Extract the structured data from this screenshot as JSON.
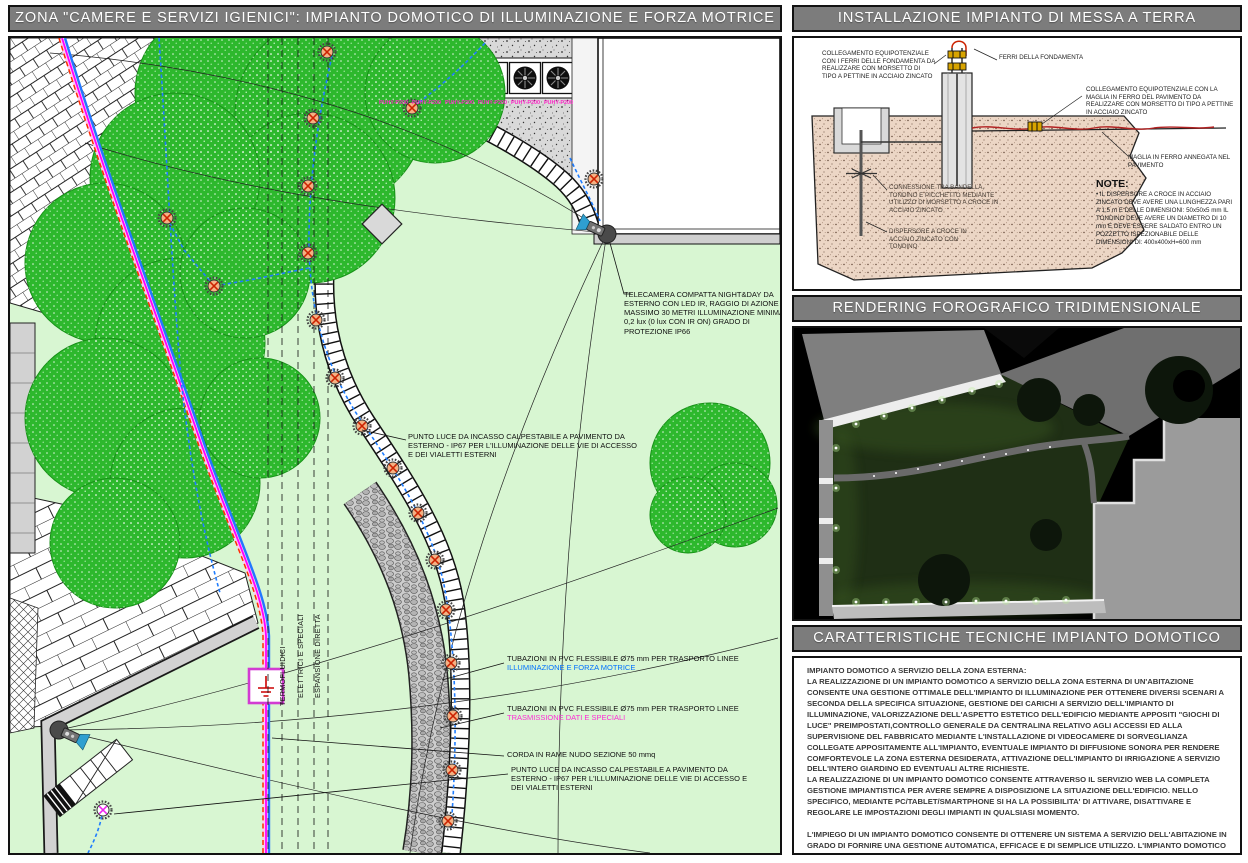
{
  "left": {
    "title": "ZONA \"CAMERE E SERVIZI IGIENICI\": IMPIANTO DOMOTICO DI ILLUMINAZIONE E FORZA MOTRICE",
    "corridor_labels": [
      "TERMOFLUIDICI",
      "ELETTRICI E SPECIALI",
      "ESPANSIONE DIRETTA"
    ],
    "unit_labels": [
      "PUHY-P200",
      "PUHY-P200",
      "PUHY-P200",
      "PUHY-P200",
      "PUHY-P200",
      "PUHY-P200"
    ],
    "annotations": {
      "camera": "TELECAMERA COMPATTA NIGHT&DAY DA ESTERNO CON LED IR, RAGGIO DI AZIONE MASSIMO 30 METRI ILLUMINAZIONE MINIMA 0,2 lux (0 lux CON IR ON) GRADO DI PROTEZIONE IP66",
      "floor_light_top": "PUNTO LUCE DA INCASSO CALPESTABILE A PAVIMENTO DA ESTERNO - IP67 PER L'ILLUMINAZIONE DELLE VIE DI ACCESSO E DEI VIALETTI ESTERNI",
      "pvc_power_prefix": "TUBAZIONI IN PVC FLESSIBILE Ø75 mm PER TRASPORTO LINEE ",
      "pvc_power_highlight": "ILLUMINAZIONE E FORZA MOTRICE",
      "pvc_data_prefix": "TUBAZIONI IN PVC FLESSIBILE Ø75 mm PER TRASPORTO LINEE ",
      "pvc_data_highlight": "TRASMISSIONE DATI E SPECIALI",
      "copper_rope": "CORDA IN RAME NUDO SEZIONE 50 mmq",
      "floor_light_bottom": "PUNTO LUCE DA INCASSO CALPESTABILE A PAVIMENTO DA ESTERNO - IP67 PER L'ILLUMINAZIONE DELLE VIE DI ACCESSO E DEI VIALETTI ESTERNI"
    }
  },
  "grounding": {
    "title": "INSTALLAZIONE IMPIANTO DI MESSA A TERRA",
    "labels": {
      "equipotential_foundation": "COLLEGAMENTO EQUIPOTENZIALE CON I FERRI DELLE FONDAMENTA DA REALIZZARE CON MORSETTO DI TIPO A PETTINE IN ACCIAIO ZINCATO",
      "foundation_bars": "FERRI DELLA FONDAMENTA",
      "equipotential_floor": "COLLEGAMENTO EQUIPOTENZIALE CON LA MAGLIA IN FERRO DEL PAVIMENTO DA REALIZZARE CON MORSETTO DI TIPO A PETTINE IN ACCIAIO ZINCATO",
      "floor_mesh": "MAGLIA IN FERRO ANNEGATA NEL PAVIMENTO",
      "connection": "CONNESSIONE TRA BANDELLA, TONDINO E PICCHETTO MEDIANTE UTILIZZO DI MORSETTO A CROCE IN ACCIAIO ZINCATO",
      "earth_rod": "DISPERSORE A CROCE IN ACCIAIO ZINCATO CON TONDINO",
      "note_title": "NOTE:",
      "note_body": "• IL DISPERSORE A CROCE IN ACCIAIO ZINCATO DEVE AVERE UNA LUNGHEZZA PARI A 1,5 m E DELLE DIMENSIONI: 50x50x5 mm IL TONDINO DEVE AVERE UN DIAMETRO DI 10 mm E DEVE ESSERE SALDATO ENTRO UN POZZETTO ISPEZIONABILE DELLE DIMENSIONI DI: 400x400xH=600 mm"
    }
  },
  "rendering": {
    "title": "RENDERING FOROGRAFICO TRIDIMENSIONALE"
  },
  "tech": {
    "title": "CARATTERISTICHE TECNICHE IMPIANTO DOMOTICO",
    "p1_heading": "IMPIANTO DOMOTICO A SERVIZIO DELLA ZONA ESTERNA:",
    "p1": "LA REALIZZAZIONE DI UN IMPIANTO DOMOTICO A SERVIZIO DELLA ZONA ESTERNA DI UN'ABITAZIONE CONSENTE UNA GESTIONE OTTIMALE DELL'IMPIANTO DI ILLUMINAZIONE PER OTTENERE DIVERSI SCENARI A SECONDA DELLA SPECIFICA SITUAZIONE, GESTIONE DEI CARICHI A SERVIZIO DELL'IMPIANTO DI ILLUMINAZIONE, VALORIZZAZIONE DELL'ASPETTO ESTETICO DELL'EDIFICIO MEDIANTE APPOSITI \"GIOCHI DI LUCE\" PREIMPOSTATI,CONTROLLO GENERALE DA CENTRALINA RELATIVO AGLI ACCESSI ED ALLA SUPERVISIONE DEL FABBRICATO MEDIANTE L'INSTALLAZIONE DI VIDEOCAMERE DI SORVEGLIANZA COLLEGATE APPOSITAMENTE ALL'IMPIANTO, EVENTUALE IMPIANTO DI DIFFUSIONE SONORA PER RENDERE COMFORTEVOLE LA ZONA ESTERNA DESIDERATA, ATTIVAZIONE DELL'IMPIANTO DI IRRIGAZIONE A SERVIZIO DELL'INTERO GIARDINO ED EVENTUALI ALTRE RICHIESTE.",
    "p2": "LA REALIZZAZIONE DI UN IMPIANTO DOMOTICO CONSENTE ATTRAVERSO IL SERVIZIO WEB LA COMPLETA GESTIONE IMPIANTISTICA PER AVERE SEMPRE A DISPOSIZIONE LA SITUAZIONE DELL'EDIFICIO. NELLO SPECIFICO, MEDIANTE PC/TABLET/SMARTPHONE SI HA LA POSSIBILITA' DI ATTIVARE, DISATTIVARE E REGOLARE LE IMPOSTAZIONI DEGLI IMPIANTI IN QUALSIASI MOMENTO.",
    "p3": "L'IMPIEGO DI UN IMPIANTO DOMOTICO CONSENTE DI OTTENERE UN SISTEMA A SERVIZIO DELL'ABITAZIONE IN GRADO DI FORNIRE UNA GESTIONE AUTOMATICA, EFFICACE E DI SEMPLICE UTILIZZO. L'IMPIANTO DOMOTICO E' IN GRADO DI MIGLIORARE IL BENESSERE FRUIBILE NEI VARI LOCALI DELLA CASA, OTTIMIZZA IL CONSUMO ENERGETICO RIDUCENDO I COSTI DI GESTIONE E,SOPRATTUTTO, AIUTA A SODDISFARE ESIGENZE FONDAMENTALI RIGUARDANTI COMFORT, SICUREZZA, GESTIONE E CONTROLLO.",
    "colors": {
      "accent_blue": "#0070ff",
      "accent_magenta": "#ff2bd6",
      "header_gray": "#7c7c7c"
    }
  }
}
